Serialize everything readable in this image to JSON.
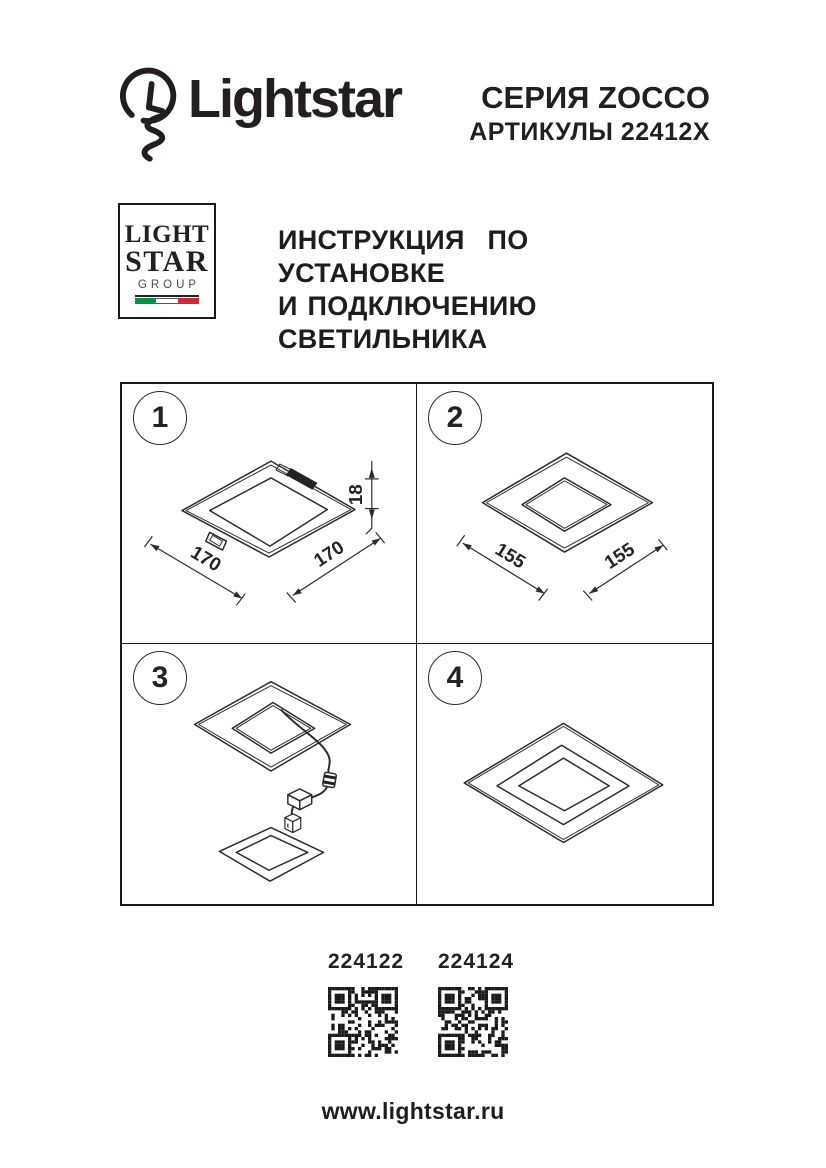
{
  "header": {
    "brand": "Lightstar",
    "series": "СЕРИЯ ZOCCO",
    "articles_line": "АРТИКУЛЫ 22412Х"
  },
  "logo_box": {
    "line1": "LIGHT",
    "line2": "STAR",
    "line3": "GROUP",
    "flag_colors": [
      "#009246",
      "#ffffff",
      "#ce2b37"
    ]
  },
  "title": {
    "line1": "ИНСТРУКЦИЯ ПО УСТАНОВКЕ",
    "line2": "И ПОДКЛЮЧЕНИЮ СВЕТИЛЬНИКА"
  },
  "steps": [
    {
      "number": "1",
      "dim_left": "170",
      "dim_right": "170",
      "dim_height": "18"
    },
    {
      "number": "2",
      "dim_left": "155",
      "dim_right": "155"
    },
    {
      "number": "3"
    },
    {
      "number": "4"
    }
  ],
  "products": [
    {
      "article": "224122"
    },
    {
      "article": "224124"
    }
  ],
  "footer": {
    "website": "www.lightstar.ru"
  },
  "colors": {
    "ink": "#231f20",
    "line": "#2b2b2b"
  }
}
